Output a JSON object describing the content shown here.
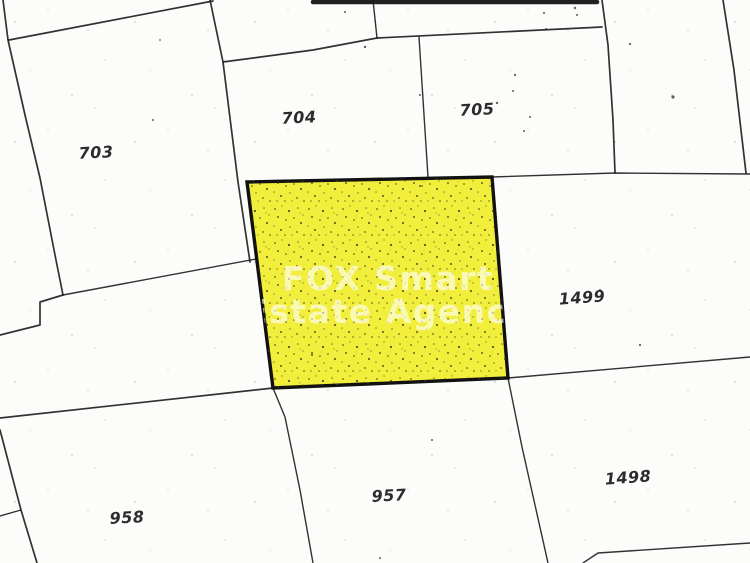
{
  "map": {
    "type": "cadastral-plan-scan",
    "background_color": "#fcfcfa",
    "boundary_line_color": "#212121",
    "parcels": [
      {
        "id": "703",
        "label": "703"
      },
      {
        "id": "704",
        "label": "704"
      },
      {
        "id": "705",
        "label": "705"
      },
      {
        "id": "1499",
        "label": "1499"
      },
      {
        "id": "1498",
        "label": "1498"
      },
      {
        "id": "957",
        "label": "957"
      },
      {
        "id": "958",
        "label": "958"
      }
    ],
    "highlight": {
      "fill_color": "#f2ee3c",
      "border_color": "#111111",
      "watermark_line1": "FOX Smart",
      "watermark_line2": "Estate Agency",
      "watermark_color": "#ffffff"
    }
  }
}
